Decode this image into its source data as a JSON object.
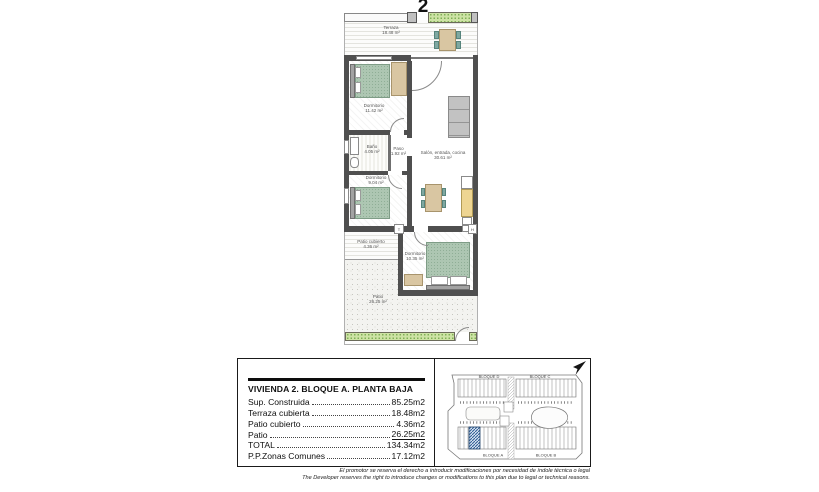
{
  "sheet": {
    "unit_number": "2"
  },
  "floor_plan": {
    "rooms": {
      "terraza": {
        "name": "Terraza",
        "area": "18.48 m²"
      },
      "dormitorio_1": {
        "name": "Dormitorio",
        "area": "11.42 m²"
      },
      "bano": {
        "name": "Baño",
        "area": "4.05 m²"
      },
      "paso": {
        "name": "Paso",
        "area": "1.92 m²"
      },
      "dormitorio_2": {
        "name": "Dormitorio",
        "area": "9.04 m²"
      },
      "salon": {
        "name": "Salón, entrada, cocina",
        "area": "30.61 m²"
      },
      "patio_cubierto": {
        "name": "Patio cubierto",
        "area": "4.36 m²"
      },
      "dormitorio_3": {
        "name": "Dormitorio",
        "area": "10.35 m²"
      },
      "patio": {
        "name": "Patio",
        "area": "26.25 m²"
      }
    },
    "fixtures": {
      "termo": "T",
      "hidro": "H"
    }
  },
  "info_panel": {
    "title": "VIVIENDA 2. BLOQUE A. PLANTA BAJA",
    "rows": [
      {
        "label": "Sup. Construida",
        "value": "85.25m2"
      },
      {
        "label": "Terraza cubierta",
        "value": "18.48m2"
      },
      {
        "label": "Patio cubierto",
        "value": "4.36m2"
      },
      {
        "label": "Patio",
        "value": "26.25m2"
      },
      {
        "label": "TOTAL",
        "value": "134.34m2"
      },
      {
        "label": "P.P.Zonas Comunes",
        "value": "17.12m2"
      }
    ]
  },
  "site_plan": {
    "blocks": {
      "top_left": "BLOQUE D",
      "top_right": "BLOQUE C",
      "bottom_left": "BLOQUE A",
      "bottom_right": "BLOQUE B"
    },
    "highlight_color": "#2e5c94"
  },
  "disclaimer": {
    "line_es": "El promotor se reserva el derecho a introducir modificaciones por necesidad de índole técnica o legal",
    "line_en": "The Developer reserves the right to introduce changes or modifications to this plan due to legal or technical reasons."
  },
  "colors": {
    "wall": "#4f4f4f",
    "bed": "#adc6b2",
    "wood": "#d9c6a2",
    "chair": "#7fa8a1",
    "hedge": "#cde3a4",
    "highlight": "#2e5c94"
  }
}
